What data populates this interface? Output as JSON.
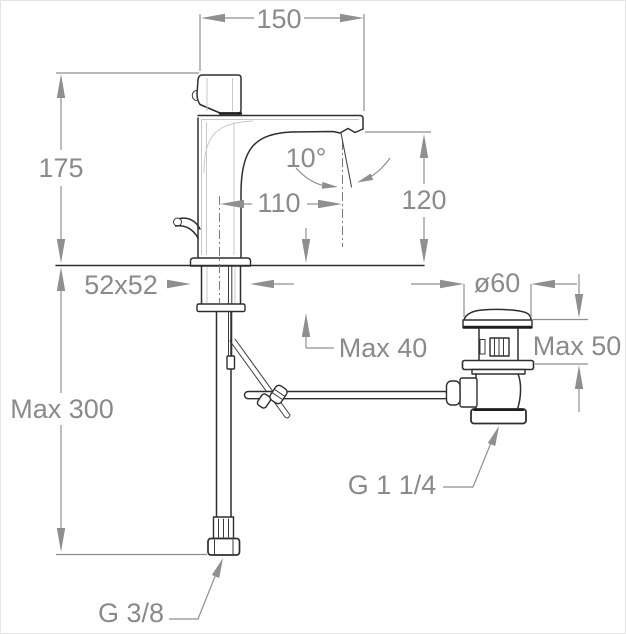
{
  "drawing": {
    "colors": {
      "object_line": "#2e2e2e",
      "dimension_line": "#8f8f8f",
      "dimension_text": "#8a8a8a",
      "background": "#ffffff"
    },
    "dimensions": {
      "spout_top_width": "150",
      "body_height": "175",
      "spout_angle": "10°",
      "spout_reach": "110",
      "outlet_height": "120",
      "base_section": "52x52",
      "waste_flange_diameter": "ø60",
      "faucet_deck_max": "Max 40",
      "waste_deck_max": "Max 50",
      "hose_max_length": "Max 300",
      "waste_thread": "G 1 1/4",
      "supply_thread": "G 3/8"
    }
  }
}
